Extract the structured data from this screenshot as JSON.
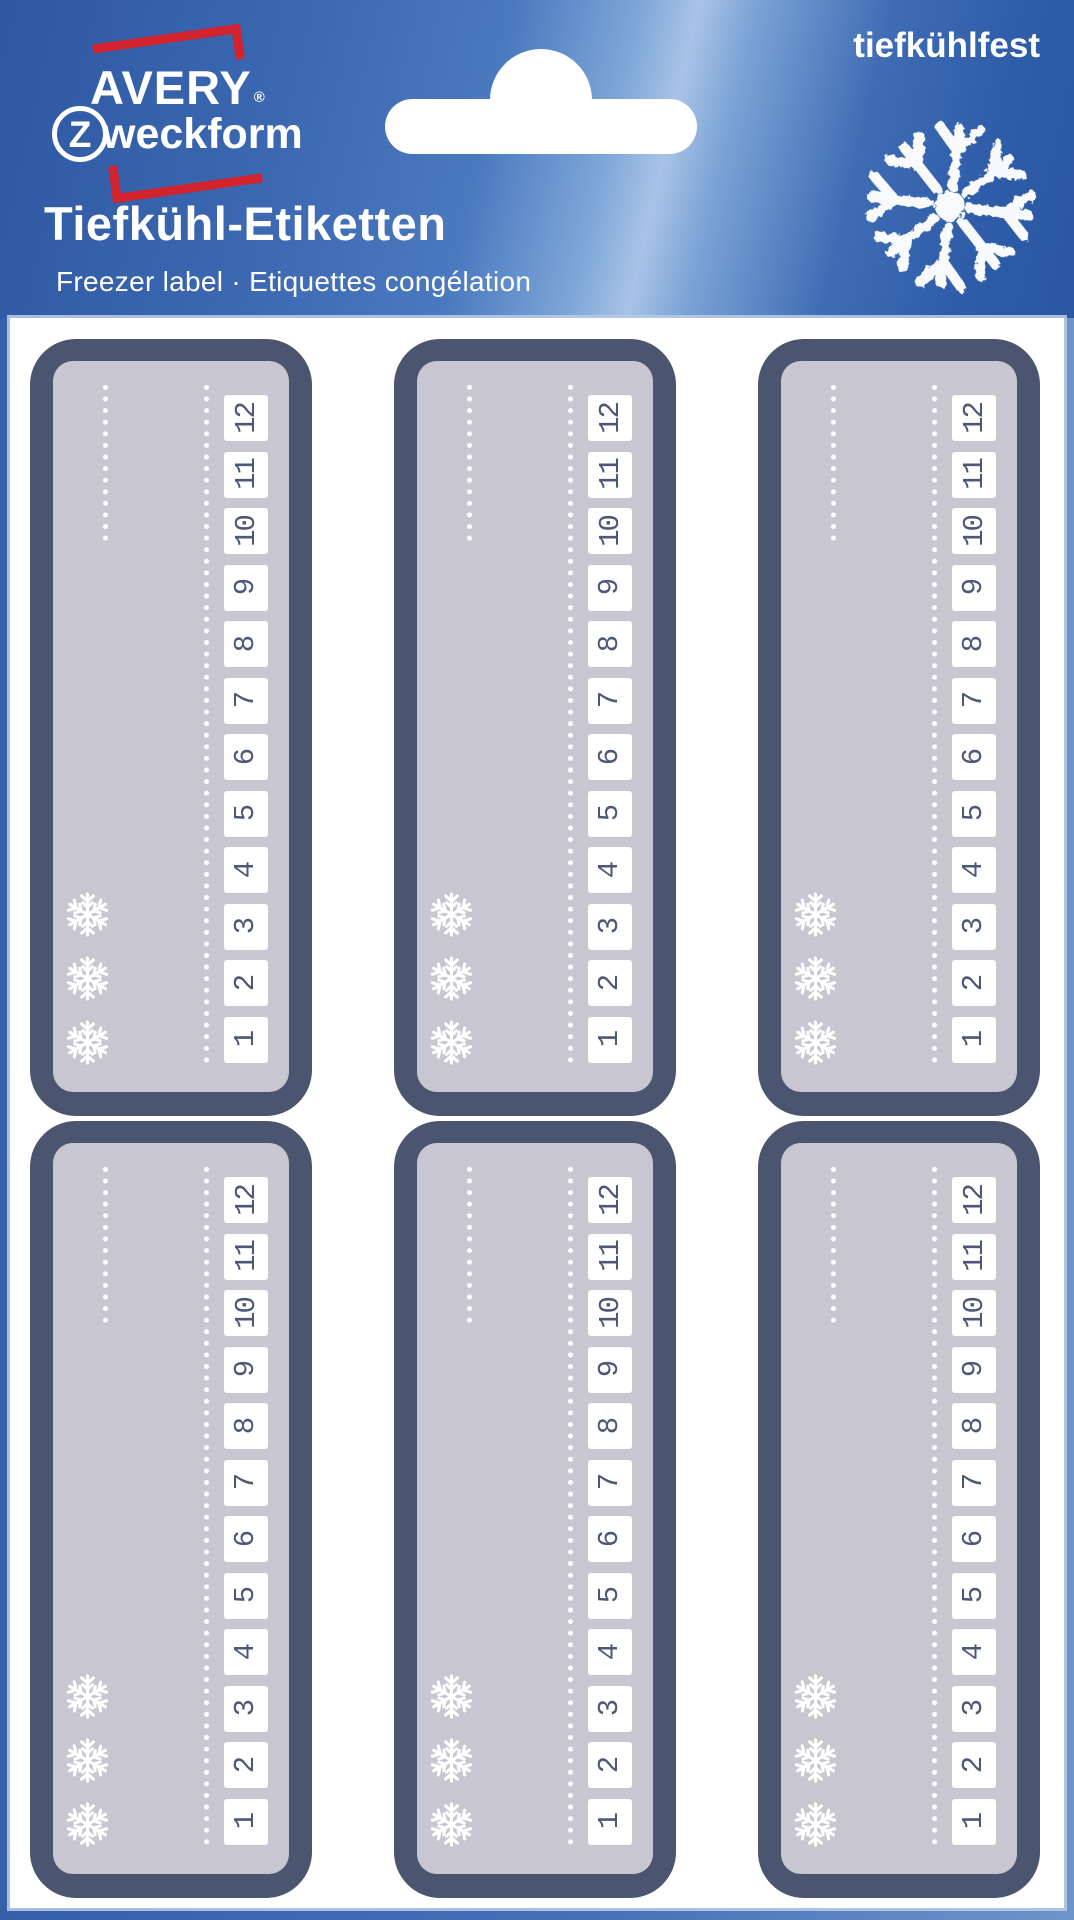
{
  "header": {
    "logo": {
      "avery": "AVERY",
      "registered": "®",
      "z_initial": "Z",
      "zweckform_rest": "weckform"
    },
    "claim": "tiefkühlfest",
    "title": "Tiefkühl-Etiketten",
    "subtitle": "Freezer label · Etiquettes congélation"
  },
  "sheet": {
    "rows": 2,
    "columns": 3,
    "label_count": 6,
    "month_numbers_top_to_bottom": [
      "12",
      "11",
      "10",
      "9",
      "8",
      "7",
      "6",
      "5",
      "4",
      "3",
      "2",
      "1"
    ],
    "snowflakes_per_label": 3
  },
  "colors": {
    "brand_red": "#d2232f",
    "header_blue": "#3a67b1",
    "frame_blue": "#3560a9",
    "label_border": "#4b556f",
    "label_fill": "#c8c7d1",
    "month_text": "#4d5878",
    "white": "#ffffff"
  }
}
